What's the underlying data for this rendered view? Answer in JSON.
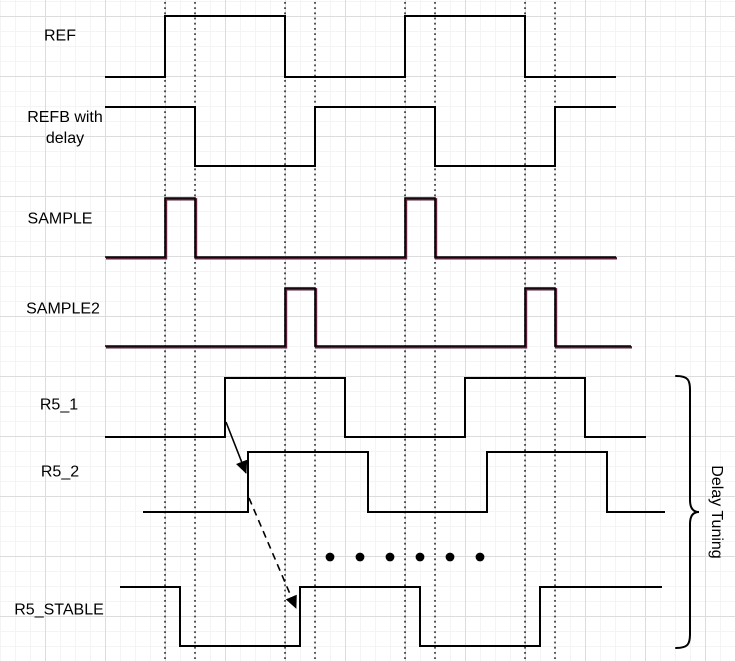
{
  "diagram": {
    "type": "timing-diagram",
    "colors": {
      "line": "#000000",
      "accent_underlay": "#5a1f38",
      "grid_minor": "#f4f4f4",
      "grid_major": "#dcdcdc",
      "canvas": "#ffffff"
    },
    "signals": [
      {
        "name": "REF",
        "dual": false,
        "points": [
          [
            105,
            77
          ],
          [
            165,
            77
          ],
          [
            165,
            16
          ],
          [
            285,
            16
          ],
          [
            285,
            77
          ],
          [
            405,
            77
          ],
          [
            405,
            16
          ],
          [
            525,
            16
          ],
          [
            525,
            77
          ],
          [
            616,
            77
          ]
        ]
      },
      {
        "name": "REFB with delay",
        "dual": false,
        "points": [
          [
            105,
            107
          ],
          [
            195,
            107
          ],
          [
            195,
            166
          ],
          [
            315,
            166
          ],
          [
            315,
            107
          ],
          [
            435,
            107
          ],
          [
            435,
            166
          ],
          [
            555,
            166
          ],
          [
            555,
            107
          ],
          [
            616,
            107
          ]
        ]
      },
      {
        "name": "SAMPLE",
        "dual": true,
        "points": [
          [
            105,
            257
          ],
          [
            165,
            257
          ],
          [
            165,
            198
          ],
          [
            195,
            198
          ],
          [
            195,
            257
          ],
          [
            405,
            257
          ],
          [
            405,
            198
          ],
          [
            435,
            198
          ],
          [
            435,
            257
          ],
          [
            616,
            257
          ]
        ]
      },
      {
        "name": "SAMPLE2",
        "dual": true,
        "points": [
          [
            105,
            346
          ],
          [
            285,
            346
          ],
          [
            285,
            288
          ],
          [
            315,
            288
          ],
          [
            315,
            346
          ],
          [
            525,
            346
          ],
          [
            525,
            288
          ],
          [
            555,
            288
          ],
          [
            555,
            346
          ],
          [
            631,
            346
          ]
        ]
      },
      {
        "name": "R5_1",
        "dual": false,
        "points": [
          [
            105,
            437
          ],
          [
            225,
            437
          ],
          [
            225,
            378
          ],
          [
            345,
            378
          ],
          [
            345,
            437
          ],
          [
            465,
            437
          ],
          [
            465,
            378
          ],
          [
            585,
            378
          ],
          [
            585,
            437
          ],
          [
            646,
            437
          ]
        ]
      },
      {
        "name": "R5_2",
        "dual": false,
        "points": [
          [
            143,
            512
          ],
          [
            248,
            512
          ],
          [
            248,
            452
          ],
          [
            368,
            452
          ],
          [
            368,
            512
          ],
          [
            487,
            512
          ],
          [
            487,
            452
          ],
          [
            607,
            452
          ],
          [
            607,
            512
          ],
          [
            665,
            512
          ]
        ]
      },
      {
        "name": "R5_STABLE",
        "dual": false,
        "points": [
          [
            120,
            587
          ],
          [
            180,
            587
          ],
          [
            180,
            646
          ],
          [
            300,
            646
          ],
          [
            300,
            587
          ],
          [
            420,
            587
          ],
          [
            420,
            646
          ],
          [
            540,
            646
          ],
          [
            540,
            587
          ],
          [
            662,
            587
          ]
        ]
      }
    ],
    "guide_lines_x": [
      165,
      195,
      285,
      315,
      405,
      435,
      525,
      555
    ],
    "ellipsis_dots": {
      "y": 557,
      "xs": [
        330,
        360,
        390,
        420,
        450,
        480
      ],
      "radius": 4.4
    },
    "arrows": [
      {
        "style": "solid",
        "from": [
          226,
          422
        ],
        "to": [
          246,
          473
        ]
      },
      {
        "style": "dashed",
        "from": [
          249,
          498
        ],
        "to": [
          296,
          608
        ]
      }
    ],
    "brace": {
      "x": 676,
      "stem_x": 690,
      "tip_x": 699,
      "y_top": 376,
      "y_bottom": 648,
      "y_tip": 512,
      "label": "Delay Tuning"
    }
  }
}
